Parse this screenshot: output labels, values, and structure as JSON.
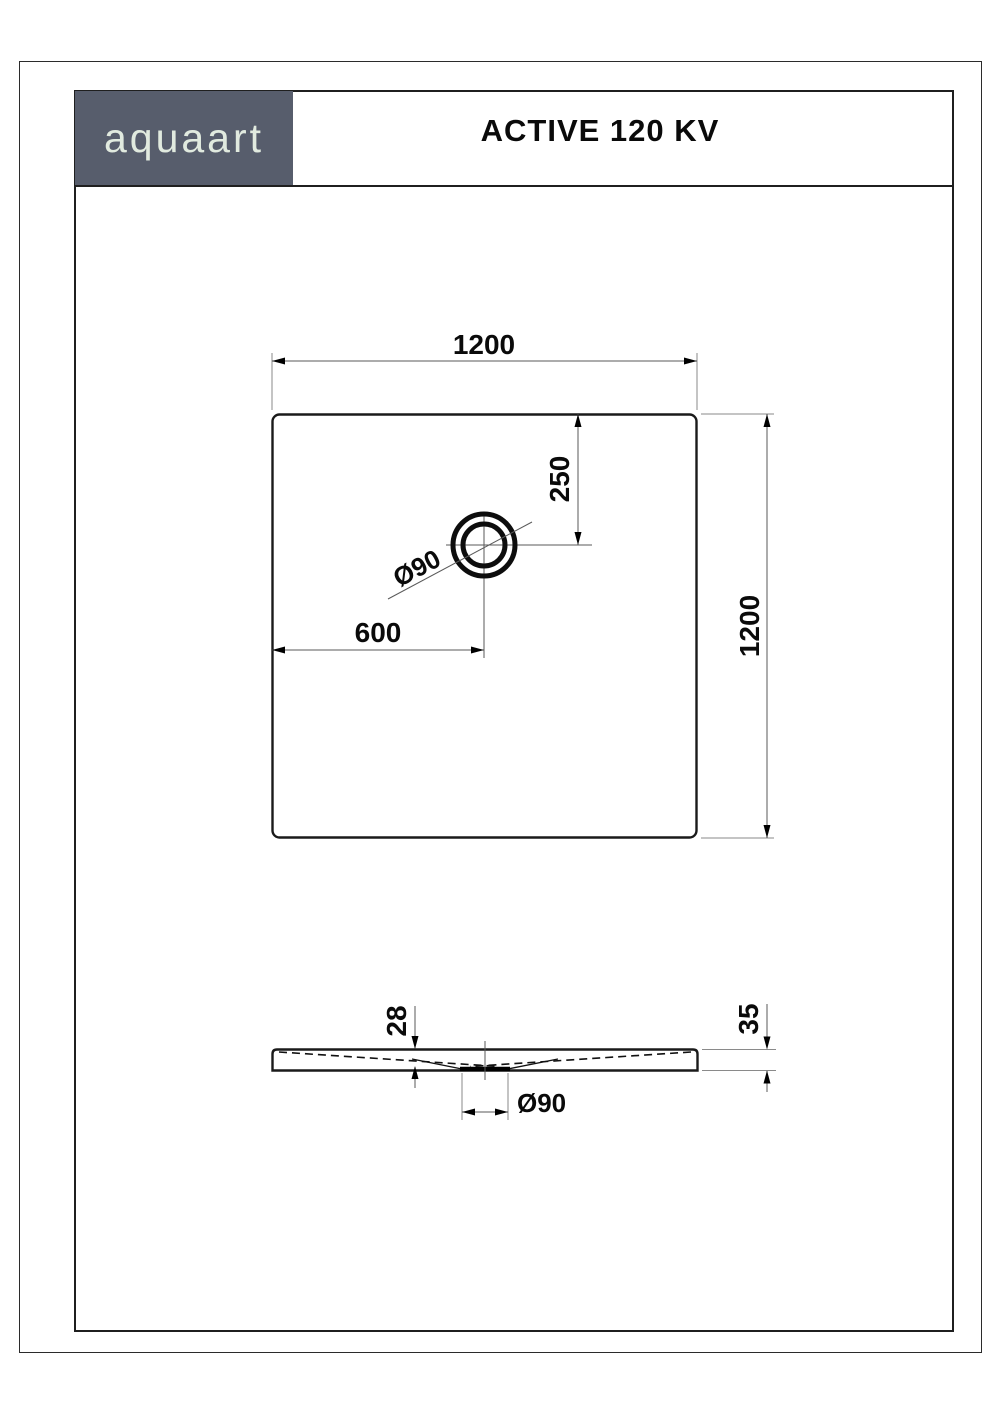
{
  "brand": {
    "logo": "aquaart"
  },
  "header": {
    "title": "ACTIVE 120 KV"
  },
  "colors": {
    "logo_background": "#575d6c",
    "logo_text": "#e1eadf",
    "object_line": "#1a1a1a",
    "dimension_line": "#5a5a5a"
  },
  "drawing": {
    "top_view": {
      "dim_width": "1200",
      "dim_height": "1200",
      "dim_drain_from_top": "250",
      "dim_drain_from_left": "600",
      "drain_diameter": "Ø90"
    },
    "section_view": {
      "dim_depth_to_drain": "28",
      "dim_edge_height": "35",
      "drain_diameter": "Ø90"
    }
  }
}
